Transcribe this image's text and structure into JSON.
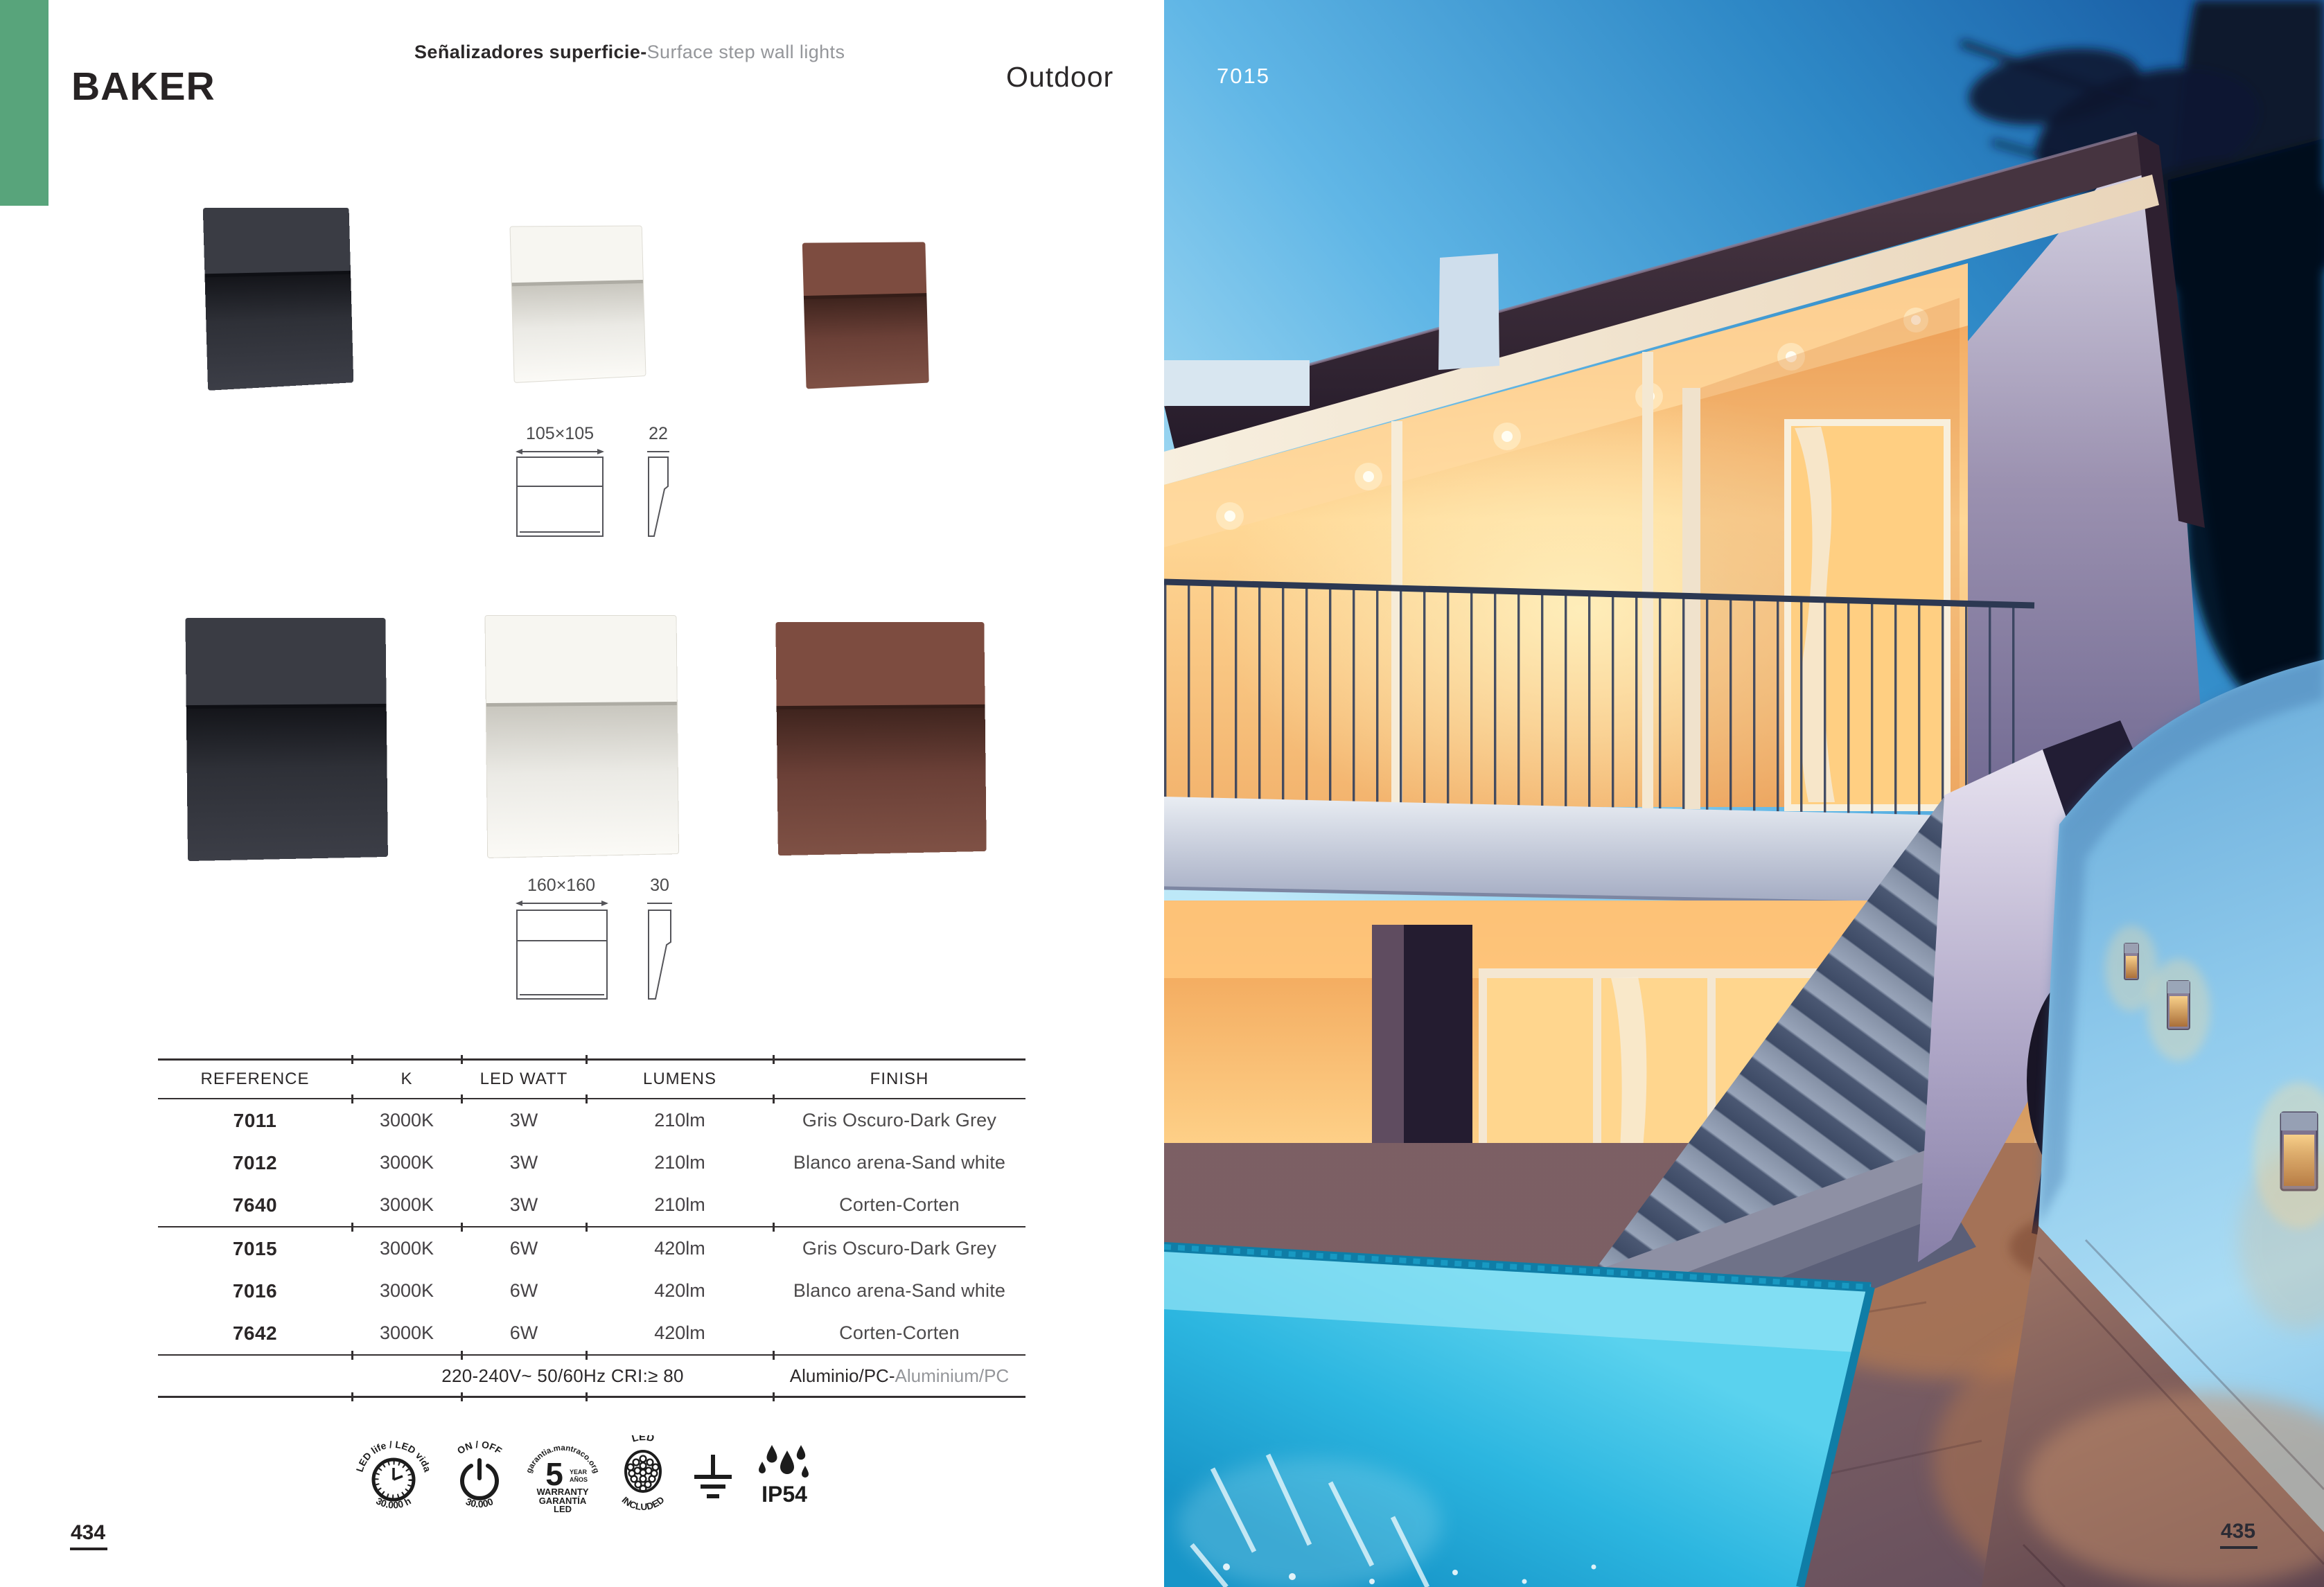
{
  "header": {
    "product_name": "BAKER",
    "category_es": "Señalizadores superficie-",
    "category_en": "Surface step wall lights",
    "section": "Outdoor",
    "photo_ref": "7015"
  },
  "diagrams": {
    "small": {
      "front": "105×105",
      "depth": "22"
    },
    "large": {
      "front": "160×160",
      "depth": "30"
    }
  },
  "table": {
    "headers": [
      "REFERENCE",
      "K",
      "LED WATT",
      "LUMENS",
      "FINISH"
    ],
    "rows": [
      {
        "reference": "7011",
        "k": "3000K",
        "led_watt": "3W",
        "lumens": "210lm",
        "finish": "Gris Oscuro-Dark Grey"
      },
      {
        "reference": "7012",
        "k": "3000K",
        "led_watt": "3W",
        "lumens": "210lm",
        "finish": "Blanco arena-Sand white"
      },
      {
        "reference": "7640",
        "k": "3000K",
        "led_watt": "3W",
        "lumens": "210lm",
        "finish": "Corten-Corten"
      },
      {
        "reference": "7015",
        "k": "3000K",
        "led_watt": "6W",
        "lumens": "420lm",
        "finish": "Gris Oscuro-Dark Grey"
      },
      {
        "reference": "7016",
        "k": "3000K",
        "led_watt": "6W",
        "lumens": "420lm",
        "finish": "Blanco arena-Sand white"
      },
      {
        "reference": "7642",
        "k": "3000K",
        "led_watt": "6W",
        "lumens": "420lm",
        "finish": "Corten-Corten"
      }
    ],
    "footer": {
      "electrical": "220-240V~ 50/60Hz CRI:≥ 80",
      "material_es": "Aluminio/PC-",
      "material_en": "Aluminium/PC"
    }
  },
  "icons": {
    "led_life_top": "LED life / LED vida",
    "led_life_bottom": "30.000 h",
    "onoff_top": "ON / OFF",
    "onoff_bottom": "30.000",
    "warranty_arc": "garantia.mantraco.org",
    "warranty_number": "5",
    "warranty_year": "YEAR",
    "warranty_anos": "AÑOS",
    "warranty_line1": "WARRANTY",
    "warranty_line2": "GARANTÍA",
    "warranty_line3": "LED",
    "led_included_top": "LED",
    "led_included_bottom": "INCLUDED",
    "ip_rating": "IP54"
  },
  "page": {
    "left_number": "434",
    "right_number": "435"
  },
  "colors": {
    "green_tab": "#58a47b",
    "text_dark": "#2b2829",
    "text_grey": "#94969a",
    "pool_cyan": "#2cb6e0",
    "wall_blue": "#8fcaec"
  }
}
